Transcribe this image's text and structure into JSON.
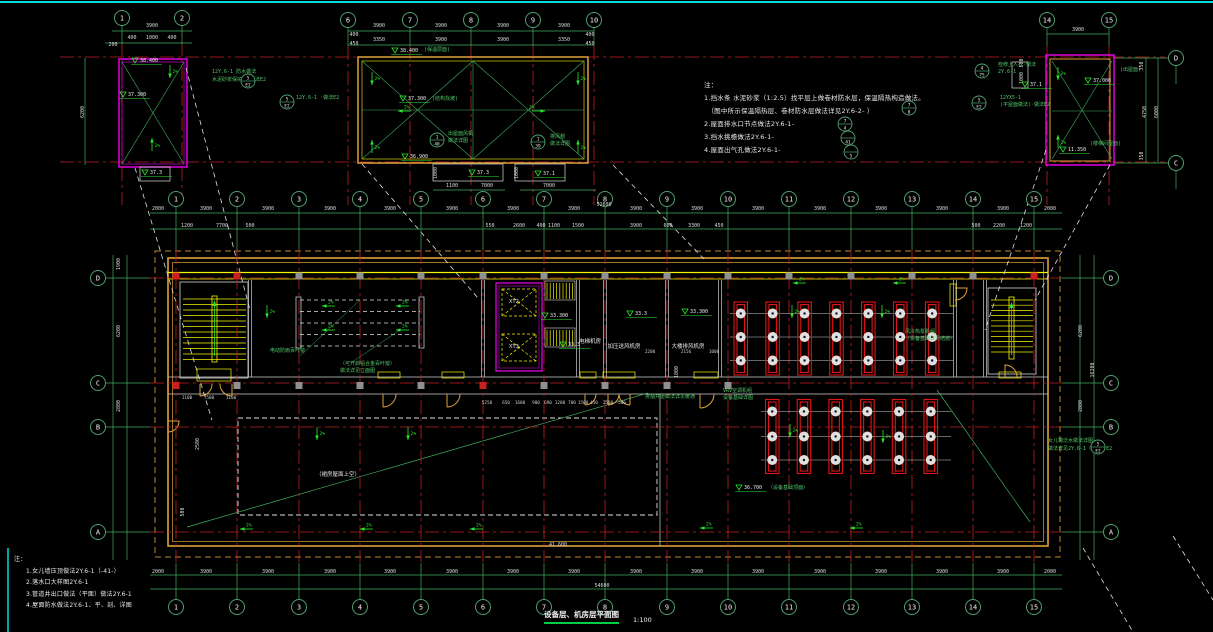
{
  "canvas": {
    "w": 1213,
    "h": 632
  },
  "colors": {
    "bg": "#000000",
    "cyan": "#00d9d9",
    "red": "#c21f1f",
    "green": "#3fae5f",
    "green_bright": "#2ae82a",
    "yellow": "#f5f500",
    "orange": "#e2a13c",
    "magenta": "#f000f0",
    "white": "#e8e8e8",
    "gray": "#909090",
    "equip_red": "#e01414"
  },
  "title": {
    "text": "设备层、机房层平面图",
    "scale": "1:100"
  },
  "grid": {
    "cols": [
      "1",
      "2",
      "3",
      "4",
      "5",
      "6",
      "7",
      "8",
      "9",
      "10",
      "11",
      "12",
      "13",
      "14",
      "15"
    ],
    "col_x": [
      176,
      237,
      299,
      360,
      421,
      483,
      544,
      605,
      667,
      728,
      789,
      851,
      912,
      973,
      1034
    ],
    "rows": [
      [
        "D",
        278
      ],
      [
        "C",
        383
      ],
      [
        "B",
        427
      ],
      [
        "A",
        532
      ]
    ],
    "row_x_left": 98,
    "row_x_right": 1111,
    "detail_bubbles": [
      [
        "1",
        122,
        18
      ],
      [
        "2",
        182,
        18
      ],
      [
        "6",
        348,
        20
      ],
      [
        "7",
        410,
        20
      ],
      [
        "8",
        471,
        20
      ],
      [
        "9",
        533,
        20
      ],
      [
        "10",
        594,
        20
      ],
      [
        "14",
        1047,
        20
      ],
      [
        "15",
        1109,
        20
      ],
      [
        "D",
        1176,
        58
      ],
      [
        "C",
        1176,
        163
      ]
    ]
  },
  "texts": {
    "dim": [
      [
        158,
        210,
        "2000"
      ],
      [
        206,
        210,
        "3900"
      ],
      [
        268,
        210,
        "3900"
      ],
      [
        330,
        210,
        "3900"
      ],
      [
        390,
        210,
        "3900"
      ],
      [
        452,
        210,
        "3900"
      ],
      [
        513,
        210,
        "3900"
      ],
      [
        574,
        210,
        "3900"
      ],
      [
        636,
        210,
        "3900"
      ],
      [
        697,
        210,
        "3900"
      ],
      [
        758,
        210,
        "3900"
      ],
      [
        820,
        210,
        "3900"
      ],
      [
        881,
        210,
        "3900"
      ],
      [
        942,
        210,
        "3900"
      ],
      [
        1003,
        210,
        "3900"
      ],
      [
        1050,
        210,
        "2000"
      ],
      [
        604,
        206,
        "51600"
      ],
      [
        187,
        227,
        "1200"
      ],
      [
        222,
        227,
        "7700"
      ],
      [
        250,
        227,
        "500"
      ],
      [
        490,
        227,
        "550"
      ],
      [
        519,
        227,
        "2600"
      ],
      [
        541,
        227,
        "400"
      ],
      [
        554,
        227,
        "1100"
      ],
      [
        578,
        227,
        "1500"
      ],
      [
        636,
        227,
        "3900"
      ],
      [
        668,
        227,
        "600"
      ],
      [
        694,
        227,
        "3300"
      ],
      [
        719,
        227,
        "450"
      ],
      [
        976,
        227,
        "500"
      ],
      [
        999,
        227,
        "2200"
      ],
      [
        1026,
        227,
        "1200"
      ],
      [
        158,
        573,
        "2000"
      ],
      [
        206,
        573,
        "3900"
      ],
      [
        268,
        573,
        "3900"
      ],
      [
        330,
        573,
        "3900"
      ],
      [
        390,
        573,
        "3900"
      ],
      [
        452,
        573,
        "3900"
      ],
      [
        513,
        573,
        "3900"
      ],
      [
        574,
        573,
        "3900"
      ],
      [
        636,
        573,
        "3900"
      ],
      [
        697,
        573,
        "3900"
      ],
      [
        758,
        573,
        "3900"
      ],
      [
        820,
        573,
        "3900"
      ],
      [
        881,
        573,
        "3900"
      ],
      [
        942,
        573,
        "3900"
      ],
      [
        1003,
        573,
        "3900"
      ],
      [
        1050,
        573,
        "2000"
      ],
      [
        602,
        587,
        "54600"
      ],
      [
        152,
        27,
        "3900"
      ],
      [
        132,
        39,
        "400"
      ],
      [
        152,
        39,
        "1000"
      ],
      [
        172,
        39,
        "400"
      ],
      [
        113,
        46,
        "200"
      ],
      [
        379,
        27,
        "3900"
      ],
      [
        441,
        27,
        "3900"
      ],
      [
        503,
        27,
        "3900"
      ],
      [
        564,
        27,
        "3900"
      ],
      [
        379,
        41,
        "3350"
      ],
      [
        441,
        41,
        "3900"
      ],
      [
        503,
        41,
        "3900"
      ],
      [
        564,
        41,
        "3350"
      ],
      [
        354,
        36,
        "400"
      ],
      [
        354,
        45,
        "450"
      ],
      [
        590,
        36,
        "400"
      ],
      [
        590,
        45,
        "450"
      ],
      [
        452,
        187,
        "1100"
      ],
      [
        487,
        187,
        "7000"
      ],
      [
        549,
        187,
        "7000"
      ],
      [
        1078,
        31,
        "3900"
      ],
      [
        558,
        546,
        "41.600"
      ]
    ],
    "dim_rot": [
      [
        120,
        264,
        "1900"
      ],
      [
        120,
        331,
        "6200"
      ],
      [
        120,
        406,
        "2800"
      ],
      [
        199,
        444,
        "2500"
      ],
      [
        184,
        512,
        "500"
      ],
      [
        1082,
        331,
        "6200"
      ],
      [
        1082,
        406,
        "2800"
      ],
      [
        1094,
        370,
        "16200"
      ],
      [
        84,
        112,
        "6200"
      ],
      [
        437,
        173,
        "1000"
      ],
      [
        518,
        173,
        "1000"
      ],
      [
        1023,
        63,
        "500"
      ],
      [
        1023,
        78,
        "1000"
      ],
      [
        1143,
        66,
        "350"
      ],
      [
        1146,
        112,
        "4750"
      ],
      [
        1158,
        112,
        "6000"
      ],
      [
        1143,
        156,
        "350"
      ],
      [
        678,
        372,
        "1800"
      ]
    ],
    "small": [
      [
        487,
        404,
        "5250"
      ],
      [
        506,
        404,
        "650"
      ],
      [
        520,
        404,
        "1600"
      ],
      [
        536,
        404,
        "900"
      ],
      [
        548,
        404,
        "690"
      ],
      [
        560,
        404,
        "1200"
      ],
      [
        572,
        404,
        "700"
      ],
      [
        583,
        404,
        "1500"
      ],
      [
        594,
        404,
        "450"
      ],
      [
        608,
        404,
        "2500"
      ],
      [
        622,
        404,
        "500"
      ],
      [
        650,
        353,
        "2200"
      ],
      [
        686,
        353,
        "2156"
      ],
      [
        714,
        353,
        "1000"
      ],
      [
        187,
        399,
        "1100"
      ],
      [
        209,
        399,
        "7500"
      ],
      [
        231,
        399,
        "1100"
      ]
    ],
    "labels": [
      [
        514,
        303,
        "XT2"
      ],
      [
        514,
        348,
        "XT3"
      ],
      [
        590,
        343,
        "电梯机房"
      ],
      [
        624,
        348,
        "加压送风机房"
      ],
      [
        688,
        348,
        "大楼排风机房"
      ],
      [
        338,
        476,
        "（裙房屋面上空）"
      ]
    ],
    "green": [
      [
        212,
        73,
        "12Y.6-1 防水做法"
      ],
      [
        212,
        81,
        "水泥砂浆保护层·做法E2"
      ],
      [
        296,
        99,
        "12Y.6-1 ·做法E2"
      ],
      [
        448,
        135,
        "出屋面风机"
      ],
      [
        448,
        142,
        "做法详图"
      ],
      [
        550,
        138,
        "排风帽"
      ],
      [
        550,
        145,
        "做法详图"
      ],
      [
        424,
        51,
        "(保温层面)"
      ],
      [
        432,
        100,
        "(结构找坡)"
      ],
      [
        998,
        66,
        "检修上人孔·做法"
      ],
      [
        998,
        73,
        "2Y.6-1"
      ],
      [
        1000,
        99,
        "12YX5-1"
      ],
      [
        1000,
        106,
        "(平屋面做法)·做法E2"
      ],
      [
        1120,
        71,
        "(出屋面)"
      ],
      [
        1090,
        145,
        "(楼梯间屋面)"
      ],
      [
        270,
        352,
        "电动防雨百叶窗"
      ],
      [
        340,
        365,
        "（可开启铝合金百叶窗）"
      ],
      [
        340,
        372,
        "做法详见立面图"
      ],
      [
        905,
        333,
        "风冷热泵机组"
      ],
      [
        905,
        340,
        "（设备基础详见结施）"
      ],
      [
        723,
        392,
        "VRV空调机组"
      ],
      [
        723,
        399,
        "设备基础详图"
      ],
      [
        1048,
        442,
        "女儿墙泛水做法详图"
      ],
      [
        1048,
        450,
        "做法详见2Y.6-1（详图）E2"
      ],
      [
        768,
        489,
        "（设备基础顶面）"
      ],
      [
        645,
        398,
        "排烟井道做法详见暖通"
      ]
    ]
  },
  "levels": [
    [
      140,
      62,
      "38.400"
    ],
    [
      128,
      96,
      "37.300"
    ],
    [
      150,
      174,
      "37.3"
    ],
    [
      400,
      52,
      "38.400"
    ],
    [
      408,
      100,
      "37.300"
    ],
    [
      410,
      158,
      "36.900"
    ],
    [
      477,
      174,
      "37.3"
    ],
    [
      543,
      175,
      "37.1"
    ],
    [
      1093,
      82,
      "37.000"
    ],
    [
      1068,
      151,
      "11.350"
    ],
    [
      1030,
      86,
      "37.1"
    ],
    [
      550,
      317,
      "33.300"
    ],
    [
      568,
      346,
      "33.3"
    ],
    [
      635,
      315,
      "33.3"
    ],
    [
      690,
      313,
      "33.300"
    ],
    [
      744,
      489,
      "36.700"
    ]
  ],
  "slope": {
    "label": "2%",
    "items": [
      [
        170,
        78,
        "d"
      ],
      [
        152,
        138,
        "u"
      ],
      [
        372,
        85,
        "d"
      ],
      [
        578,
        85,
        "d"
      ],
      [
        372,
        140,
        "u"
      ],
      [
        578,
        140,
        "u"
      ],
      [
        398,
        111,
        "l"
      ],
      [
        545,
        111,
        "r"
      ],
      [
        1058,
        80,
        "d"
      ],
      [
        1058,
        135,
        "u"
      ],
      [
        322,
        306,
        "l"
      ],
      [
        396,
        306,
        "l"
      ],
      [
        322,
        330,
        "l"
      ],
      [
        396,
        330,
        "l"
      ],
      [
        267,
        318,
        "d"
      ],
      [
        317,
        440,
        "d"
      ],
      [
        408,
        440,
        "d"
      ],
      [
        793,
        283,
        "l"
      ],
      [
        893,
        283,
        "l"
      ],
      [
        792,
        318,
        "d"
      ],
      [
        882,
        318,
        "d"
      ],
      [
        790,
        437,
        "d"
      ],
      [
        883,
        443,
        "d"
      ],
      [
        240,
        529,
        "l"
      ],
      [
        360,
        529,
        "l"
      ],
      [
        470,
        529,
        "l"
      ],
      [
        700,
        528,
        "l"
      ],
      [
        850,
        528,
        "l"
      ]
    ]
  },
  "leaders": [
    [
      248,
      81,
      "5",
      "E2"
    ],
    [
      287,
      102,
      "5",
      "E2"
    ],
    [
      437,
      140,
      "1",
      "40"
    ],
    [
      538,
      142,
      "1",
      "39"
    ],
    [
      982,
      71,
      "4",
      "75"
    ],
    [
      979,
      103,
      "5",
      "E2"
    ],
    [
      845,
      124,
      "7",
      "4"
    ],
    [
      848,
      138,
      "",
      "41"
    ],
    [
      851,
      152,
      "",
      "5"
    ],
    [
      909,
      108,
      "7",
      "8"
    ],
    [
      1098,
      447,
      "5",
      "E2"
    ]
  ],
  "equipment": {
    "top": {
      "n": 7,
      "x0": 734,
      "dx": 31.9,
      "y": 302,
      "w": 13.5,
      "h": 73,
      "rows": [
        313.5,
        337,
        360.5
      ],
      "line_x": [
        730,
        953
      ]
    },
    "bottom": {
      "n": 6,
      "x0": 765.5,
      "dx": 31.7,
      "y": 399.5,
      "w": 13.5,
      "h": 74,
      "rows": [
        411.5,
        436.5,
        460
      ],
      "line_x": [
        761,
        951
      ]
    }
  },
  "notes_top": {
    "head": "注：",
    "lines": [
      "1.挡水条 水泥砂浆（1:2.5）找平层上做卷材防水层，保温隔热构造做法。",
      "　（图中所示保温隔热层、卷材防水层做法详见2Y.6-2- ）",
      "2.屋面排水口节点做法2Y.6-1-",
      "3.挡水挑檐做法2Y.6-1-",
      "4.屋面出气孔做法2Y.6-1-"
    ]
  },
  "notes_bottom": {
    "head": "注：",
    "lines": [
      "1.女儿墙压顶做法2Y.6-1（-41-）",
      "2.落水口大样图2Y.6-1",
      "3.管道井出口做法（平面）做法2Y.6-1",
      "4.屋面防水做法2Y.6-1、平、剖、详图"
    ]
  }
}
